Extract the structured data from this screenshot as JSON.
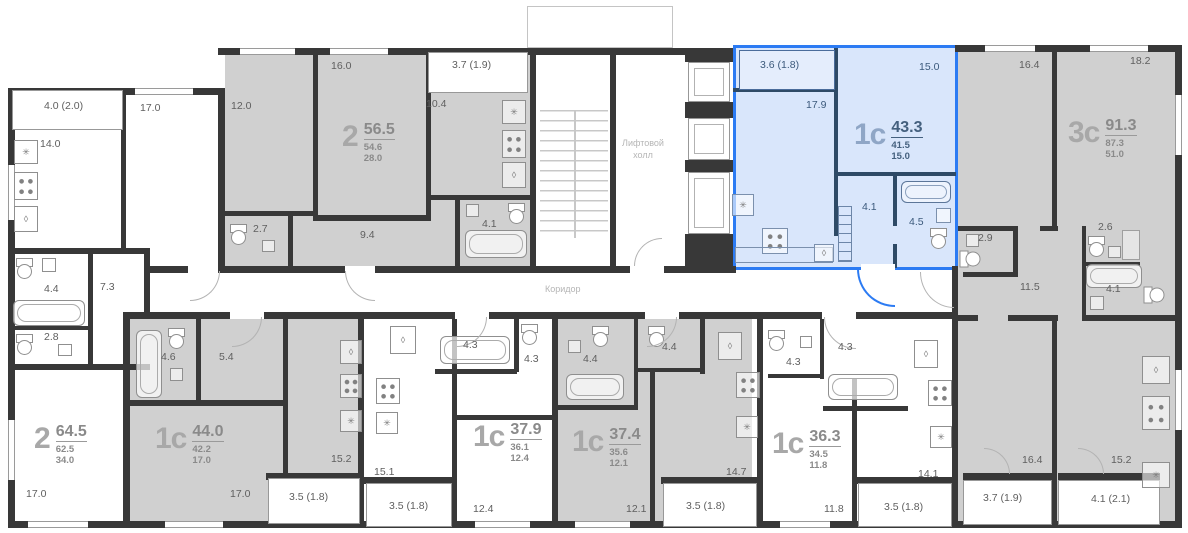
{
  "legend": {
    "elevator_hall": [
      "Лифтовой",
      "холл"
    ],
    "corridor": "Коридор"
  },
  "icons": {
    "vent": "✳",
    "sink": "○",
    "drop": "◊"
  },
  "colors": {
    "selected_fill": "#d9e6fb",
    "selected_border": "#2c7bf3",
    "apartment_fill": "#d0d0d0",
    "wall": "#383838"
  },
  "apartments": [
    {
      "type": "2",
      "total": "64.5",
      "area": "62.5",
      "living": "34.0",
      "selected": false,
      "rooms": {
        "balcony": "4.0 (2.0)",
        "kitchen": "14.0",
        "room_top": "17.0",
        "bath": "4.4",
        "hall": "7.3",
        "wc": "2.8",
        "room_bottom": "17.0"
      }
    },
    {
      "type": "2",
      "total": "56.5",
      "area": "54.6",
      "living": "28.0",
      "selected": false,
      "rooms": {
        "room1": "12.0",
        "room2": "16.0",
        "kitchen": "10.4",
        "balcony": "3.7 (1.9)",
        "wc": "2.7",
        "hall": "9.4",
        "bath": "4.1"
      }
    },
    {
      "type": "1с",
      "total": "43.3",
      "area": "41.5",
      "living": "15.0",
      "selected": true,
      "rooms": {
        "balcony": "3.6 (1.8)",
        "kitchen_living": "17.9",
        "room": "15.0",
        "hall": "4.1",
        "bath": "4.5"
      }
    },
    {
      "type": "3с",
      "total": "91.3",
      "area": "87.3",
      "living": "51.0",
      "selected": false,
      "rooms": {
        "room1": "16.4",
        "room2": "18.2",
        "wc": "2.9",
        "storage": "2.6",
        "hall": "11.5",
        "bath": "4.1",
        "room3": "16.4",
        "kitchen_living": "15.2",
        "balcony1": "3.7 (1.9)",
        "balcony2": "4.1 (2.1)"
      }
    },
    {
      "type": "1с",
      "total": "44.0",
      "area": "42.2",
      "living": "17.0",
      "selected": false,
      "rooms": {
        "bath": "4.6",
        "hall": "5.4",
        "room": "17.0",
        "kitchen_living": "15.2",
        "balcony": "3.5 (1.8)"
      }
    },
    {
      "type": "1с",
      "total": "37.9",
      "area": "36.1",
      "living": "12.4",
      "selected": false,
      "rooms": {
        "kitchen_living": "15.1",
        "bath": "4.3",
        "hall": "4.3",
        "room": "12.4",
        "balcony": "3.5 (1.8)"
      }
    },
    {
      "type": "1с",
      "total": "37.4",
      "area": "35.6",
      "living": "12.1",
      "selected": false,
      "rooms": {
        "bath": "4.4",
        "wc": "4.4",
        "kitchen_living": "14.7",
        "room": "12.1",
        "balcony": "3.5 (1.8)"
      }
    },
    {
      "type": "1с",
      "total": "36.3",
      "area": "34.5",
      "living": "11.8",
      "selected": false,
      "rooms": {
        "wc": "4.3",
        "bath": "4.3",
        "kitchen_living": "14.1",
        "room": "11.8",
        "balcony": "3.5 (1.8)"
      }
    }
  ]
}
